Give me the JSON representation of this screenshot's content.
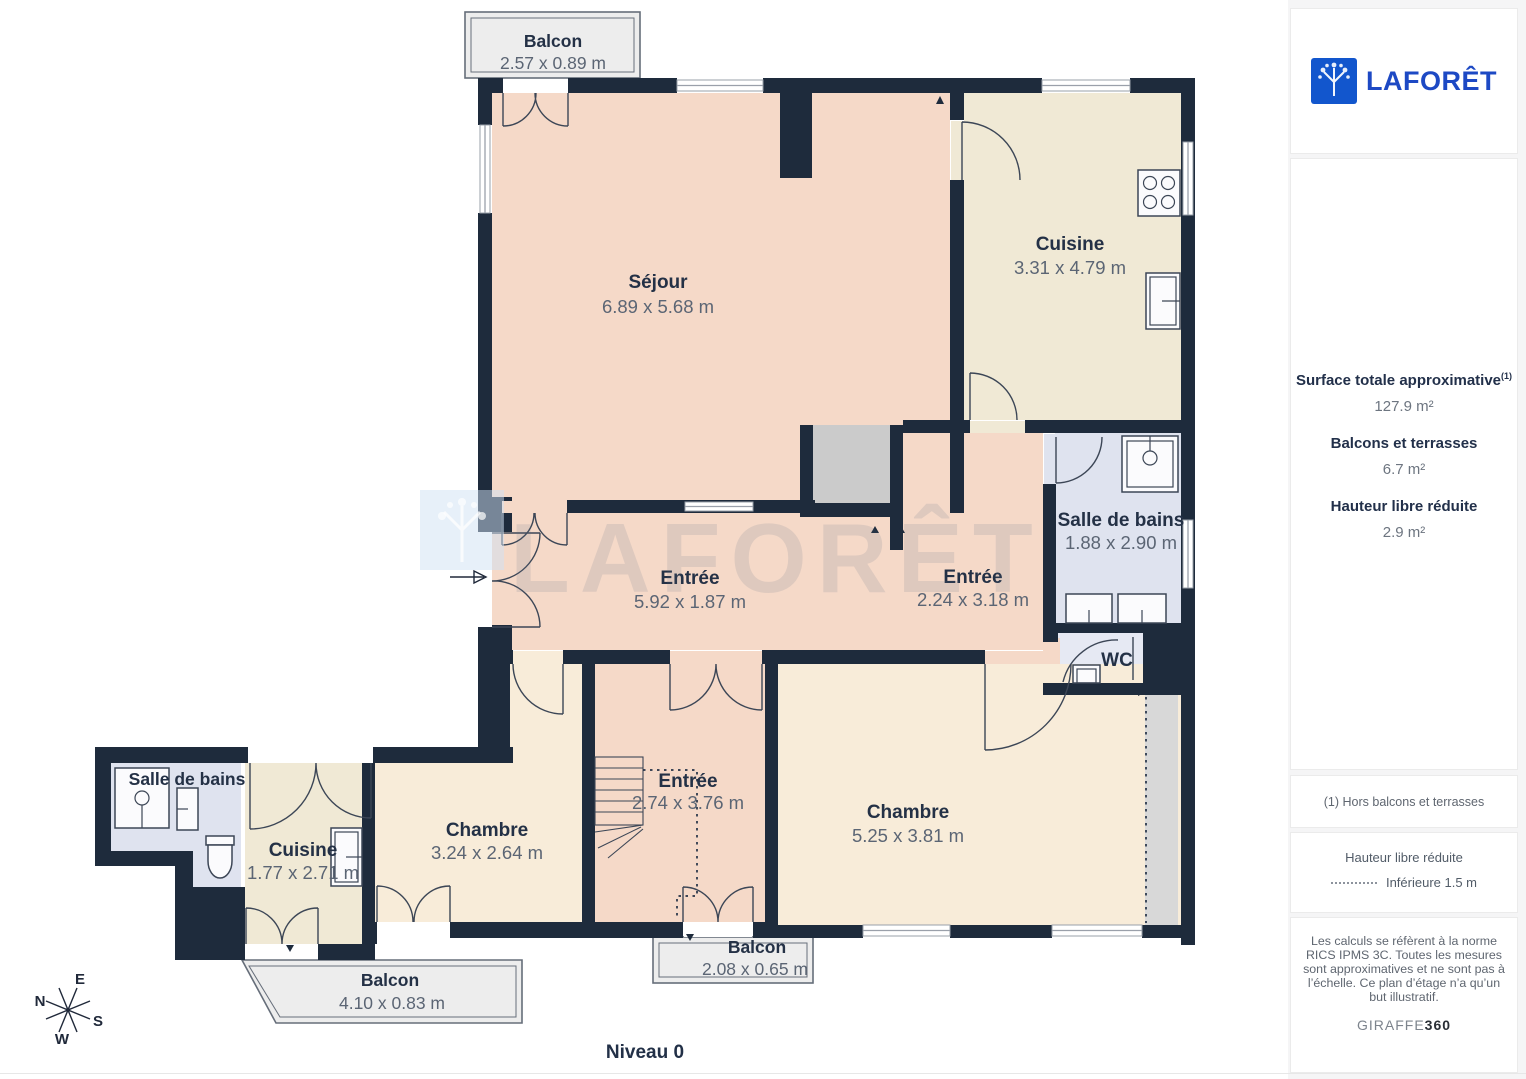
{
  "rooms": [
    {
      "id": "balcon-top",
      "name": "Balcon",
      "dims": "2.57 x 0.89 m"
    },
    {
      "id": "sejour",
      "name": "Séjour",
      "dims": "6.89 x 5.68 m"
    },
    {
      "id": "cuisine-top",
      "name": "Cuisine",
      "dims": "3.31 x 4.79 m"
    },
    {
      "id": "salle-de-bains-top",
      "name": "Salle de bains",
      "dims": "1.88 x 2.90 m"
    },
    {
      "id": "wc",
      "name": "WC",
      "dims": ""
    },
    {
      "id": "entree-main",
      "name": "Entrée",
      "dims": "5.92 x 1.87 m"
    },
    {
      "id": "entree-right",
      "name": "Entrée",
      "dims": "2.24 x 3.18 m"
    },
    {
      "id": "salle-de-bains-bottom",
      "name": "Salle de bains",
      "dims": ""
    },
    {
      "id": "cuisine-bottom",
      "name": "Cuisine",
      "dims": "1.77 x 2.71 m"
    },
    {
      "id": "chambre-left",
      "name": "Chambre",
      "dims": "3.24 x 2.64 m"
    },
    {
      "id": "entree-stairs",
      "name": "Entrée",
      "dims": "2.74 x 3.76 m"
    },
    {
      "id": "chambre-right",
      "name": "Chambre",
      "dims": "5.25 x 3.81 m"
    },
    {
      "id": "balcon-left",
      "name": "Balcon",
      "dims": "4.10 x 0.83 m"
    },
    {
      "id": "balcon-center",
      "name": "Balcon",
      "dims": "2.08 x 0.65 m"
    }
  ],
  "floor": {
    "level_label": "Niveau 0",
    "watermark": "LAFORÊT"
  },
  "compass": {
    "n": "N",
    "e": "E",
    "s": "S",
    "w": "W"
  },
  "sidebar": {
    "logo_text": "LAFORÊT",
    "stats": [
      {
        "label": "Surface totale approximative",
        "sup": "(1)",
        "value": "127.9 m²"
      },
      {
        "label": "Balcons et terrasses",
        "sup": "",
        "value": "6.7 m²"
      },
      {
        "label": "Hauteur libre réduite",
        "sup": "",
        "value": "2.9 m²"
      }
    ],
    "footnote": "(1) Hors balcons et terrasses",
    "legend": {
      "title": "Hauteur libre réduite",
      "item": "Inférieure 1.5 m"
    },
    "disclaimer": "Les calculs se réfèrent à la norme RICS IPMS 3C. Toutes les mesures sont approximatives et ne sont pas à l’échelle. Ce plan d’étage n’a qu’un but illustratif.",
    "brand": {
      "name": "GIRAFFE",
      "suffix": "360"
    }
  },
  "colors": {
    "wall": "#1e2b3c",
    "room_pink": "#f5d9c8",
    "room_cream": "#f0e9d5",
    "room_cream2": "#f8ecd9",
    "room_blue": "#dfe3ef",
    "balcony": "#ededed",
    "void": "#cbcbcb",
    "strip": "#d8d8d8",
    "brand": "#1d49c4",
    "ink": "#243146",
    "dim": "#5b6574"
  }
}
